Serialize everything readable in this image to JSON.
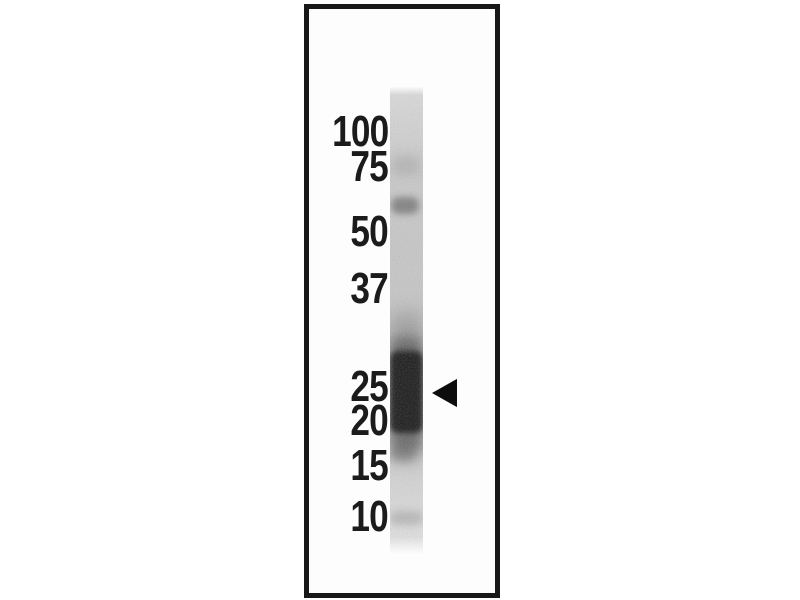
{
  "figure": {
    "kind": "western blot — single lane with molecular-weight marker ladder",
    "frame": {
      "left": 304,
      "top": 4,
      "width": 196,
      "height": 594,
      "border_color": "#181818",
      "background_color": "#fdfdfd"
    },
    "lane": {
      "left": 390,
      "top": 87,
      "width": 33,
      "height": 466,
      "background_color": "#cdcdcd"
    },
    "markers": [
      {
        "label": "100",
        "top": 132
      },
      {
        "label": "75",
        "top": 167
      },
      {
        "label": "50",
        "top": 232
      },
      {
        "label": "37",
        "top": 289
      },
      {
        "label": "25",
        "top": 387
      },
      {
        "label": "20",
        "top": 421
      },
      {
        "label": "15",
        "top": 466
      },
      {
        "label": "10",
        "top": 517
      }
    ],
    "ink_color": "#1b1b1b",
    "bands": [
      {
        "name": "faint band near 75 marker",
        "top": 68,
        "left": 2,
        "width": 28,
        "height": 20,
        "background": "rgba(110,110,110,0.22)",
        "blur": 5
      },
      {
        "name": "distinct band just above 50 marker",
        "top": 110,
        "left": 1,
        "width": 28,
        "height": 17,
        "background": "rgba(55,55,55,0.50)",
        "blur": 3.5
      },
      {
        "name": "main band outer haze (spans 25-20 markers)",
        "top": 225,
        "left": 0,
        "width": 33,
        "height": 150,
        "background": "rgba(70,70,70,0.30)",
        "blur": 9
      },
      {
        "name": "main band mid zone",
        "top": 250,
        "left": 0,
        "width": 33,
        "height": 115,
        "background": "rgba(40,40,40,0.50)",
        "blur": 6
      },
      {
        "name": "main band dark core (between 25 and 20 markers)",
        "top": 264,
        "left": 0,
        "width": 33,
        "height": 82,
        "background": "rgba(16,16,16,0.95)",
        "blur": 3
      },
      {
        "name": "faint smudge at 15 marker",
        "top": 360,
        "left": 0,
        "width": 25,
        "height": 15,
        "background": "rgba(70,70,70,0.32)",
        "blur": 4
      },
      {
        "name": "faint band at 10 marker",
        "top": 424,
        "left": 0,
        "width": 33,
        "height": 14,
        "background": "rgba(125,125,125,0.38)",
        "blur": 4
      }
    ],
    "arrow": {
      "left": 432,
      "top": 378,
      "width": 25,
      "height": 30,
      "background": "#0d0d0d",
      "direction": "left",
      "points_at": "dark band between the 25 and 20 markers"
    }
  }
}
